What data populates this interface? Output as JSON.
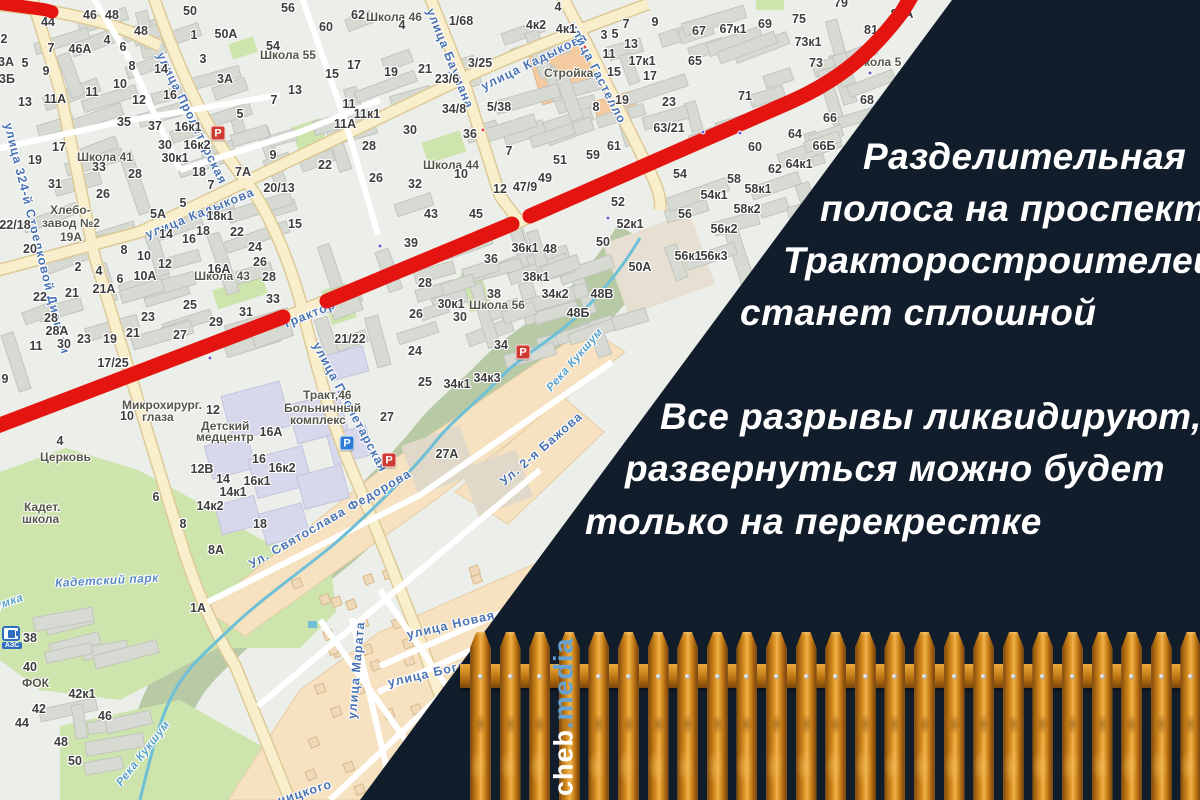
{
  "overlay": {
    "bg_color": "#121d2c",
    "text_color": "#ffffff",
    "headline_lines": [
      {
        "t": "Разделительная",
        "x": 863,
        "y": 136
      },
      {
        "t": "полоса на проспекте",
        "x": 820,
        "y": 188
      },
      {
        "t": "Тракторостроителей",
        "x": 783,
        "y": 240
      },
      {
        "t": "станет сплошной",
        "x": 740,
        "y": 292
      }
    ],
    "body_lines": [
      {
        "t": "Все разрывы ликвидируют,",
        "x": 660,
        "y": 396
      },
      {
        "t": "развернуться можно будет",
        "x": 625,
        "y": 448
      },
      {
        "t": "только на перекрестке",
        "x": 585,
        "y": 501
      }
    ]
  },
  "watermark": {
    "site": "cheb",
    "domain": ".media",
    "site_color": "#ffffff",
    "domain_color": "#66a3d2"
  },
  "map": {
    "route_color": "#e41410",
    "street_label_color": "#4a73b4",
    "street_labels": [
      {
        "t": "улица Пролетарская",
        "x": 160,
        "y": 46,
        "r": 64
      },
      {
        "t": "улица Пролетарская",
        "x": 316,
        "y": 336,
        "r": 62
      },
      {
        "t": "улица Баумана",
        "x": 430,
        "y": 2,
        "r": 68
      },
      {
        "t": "улица Кадыкова",
        "x": 146,
        "y": 228,
        "r": -22
      },
      {
        "t": "улица Кадыкова",
        "x": 482,
        "y": 80,
        "r": -26
      },
      {
        "t": "улица Гастелло",
        "x": 572,
        "y": 16,
        "r": 63
      },
      {
        "t": "улица 324-й Стрелковой Дивизии",
        "x": 8,
        "y": 116,
        "r": 76
      },
      {
        "t": "Ул. Святослава Федорова",
        "x": 250,
        "y": 558,
        "r": -30
      },
      {
        "t": "Ул. 2-я Бажова",
        "x": 502,
        "y": 476,
        "r": -41
      },
      {
        "t": "улица Новая",
        "x": 407,
        "y": 628,
        "r": -13
      },
      {
        "t": "улица Марата",
        "x": 352,
        "y": 712,
        "r": -85
      },
      {
        "t": "улица Богдана",
        "x": 388,
        "y": 676,
        "r": -13
      },
      {
        "t": "ницкого",
        "x": 278,
        "y": 794,
        "r": -18
      },
      {
        "t": "Трактор",
        "x": 283,
        "y": 318,
        "r": -22
      }
    ],
    "water_labels": [
      {
        "t": "Река Кукшум",
        "x": 549,
        "y": 384,
        "r": -49
      },
      {
        "t": "Река Кукшум",
        "x": 119,
        "y": 779,
        "r": -52
      },
      {
        "t": "Кукшумка",
        "x": -34,
        "y": 612,
        "r": -20
      }
    ],
    "park_labels": [
      {
        "t": "Кадетский парк",
        "x": 55,
        "y": 576,
        "r": -3
      }
    ],
    "poi_labels": [
      {
        "t": "Школа 41",
        "x": 77,
        "y": 150
      },
      {
        "t": "Школа 55",
        "x": 260,
        "y": 48
      },
      {
        "t": "Школа 46",
        "x": 366,
        "y": 10
      },
      {
        "t": "Школа 44",
        "x": 423,
        "y": 158
      },
      {
        "t": "Школа 43",
        "x": 194,
        "y": 269
      },
      {
        "t": "Школа 56",
        "x": 469,
        "y": 298
      },
      {
        "t": "Школа 5",
        "x": 852,
        "y": 55
      },
      {
        "t": "Хлебо-",
        "x": 50,
        "y": 203
      },
      {
        "t": "завод №2",
        "x": 42,
        "y": 216
      },
      {
        "t": "19А",
        "x": 60,
        "y": 230
      },
      {
        "t": "Микрохирург.",
        "x": 122,
        "y": 398
      },
      {
        "t": "глаза",
        "x": 142,
        "y": 410
      },
      {
        "t": "Детский",
        "x": 201,
        "y": 419
      },
      {
        "t": "медцентр",
        "x": 196,
        "y": 430
      },
      {
        "t": "Тракт,46",
        "x": 303,
        "y": 388
      },
      {
        "t": "Больничный",
        "x": 284,
        "y": 401
      },
      {
        "t": "комплекс",
        "x": 290,
        "y": 413
      },
      {
        "t": "Стройка",
        "x": 544,
        "y": 66
      },
      {
        "t": "Церковь",
        "x": 40,
        "y": 450
      },
      {
        "t": "Кадет.",
        "x": 24,
        "y": 500
      },
      {
        "t": "школа",
        "x": 22,
        "y": 512
      },
      {
        "t": "ФОК",
        "x": 22,
        "y": 676
      }
    ],
    "numbers": [
      [
        "44",
        48,
        22
      ],
      [
        "46",
        90,
        15
      ],
      [
        "48",
        112,
        15
      ],
      [
        "48",
        141,
        31
      ],
      [
        "4",
        107,
        40
      ],
      [
        "46А",
        80,
        49
      ],
      [
        "7",
        51,
        48
      ],
      [
        "5",
        25,
        63
      ],
      [
        "9",
        46,
        71
      ],
      [
        "3А",
        6,
        62
      ],
      [
        "3Б",
        7,
        79
      ],
      [
        "2",
        4,
        39
      ],
      [
        "6",
        123,
        47
      ],
      [
        "8",
        132,
        66
      ],
      [
        "14",
        161,
        69
      ],
      [
        "10",
        120,
        84
      ],
      [
        "11",
        92,
        92
      ],
      [
        "16",
        170,
        95
      ],
      [
        "12",
        139,
        100
      ],
      [
        "13",
        25,
        102
      ],
      [
        "11А",
        55,
        99
      ],
      [
        "35",
        124,
        122
      ],
      [
        "37",
        155,
        126
      ],
      [
        "16к1",
        188,
        127
      ],
      [
        "16к2",
        197,
        145
      ],
      [
        "17",
        59,
        147
      ],
      [
        "19",
        35,
        160
      ],
      [
        "33",
        99,
        167
      ],
      [
        "30",
        165,
        145
      ],
      [
        "30к1",
        175,
        158
      ],
      [
        "28",
        135,
        174
      ],
      [
        "18",
        199,
        172
      ],
      [
        "26",
        103,
        194
      ],
      [
        "31",
        55,
        184
      ],
      [
        "50",
        190,
        11
      ],
      [
        "1",
        194,
        35
      ],
      [
        "50А",
        226,
        34
      ],
      [
        "3",
        203,
        59
      ],
      [
        "3А",
        225,
        79
      ],
      [
        "54",
        273,
        46
      ],
      [
        "56",
        288,
        8
      ],
      [
        "13",
        295,
        90
      ],
      [
        "7",
        274,
        100
      ],
      [
        "5",
        240,
        114
      ],
      [
        "9",
        273,
        155
      ],
      [
        "7А",
        243,
        172
      ],
      [
        "20/13",
        279,
        188
      ],
      [
        "15",
        295,
        224
      ],
      [
        "22/18",
        15,
        225
      ],
      [
        "20",
        30,
        249
      ],
      [
        "5А",
        158,
        214
      ],
      [
        "5",
        183,
        203
      ],
      [
        "7",
        211,
        185
      ],
      [
        "14",
        166,
        234
      ],
      [
        "16",
        189,
        239
      ],
      [
        "18",
        203,
        231
      ],
      [
        "18к1",
        220,
        216
      ],
      [
        "22",
        237,
        232
      ],
      [
        "24",
        255,
        247
      ],
      [
        "26",
        260,
        262
      ],
      [
        "28",
        269,
        277
      ],
      [
        "16А",
        219,
        269
      ],
      [
        "2",
        78,
        267
      ],
      [
        "4",
        99,
        271
      ],
      [
        "6",
        120,
        279
      ],
      [
        "8",
        124,
        250
      ],
      [
        "10",
        144,
        256
      ],
      [
        "12",
        165,
        264
      ],
      [
        "10А",
        145,
        276
      ],
      [
        "21",
        72,
        293
      ],
      [
        "21А",
        104,
        289
      ],
      [
        "22",
        40,
        297
      ],
      [
        "28",
        51,
        318
      ],
      [
        "28А",
        57,
        331
      ],
      [
        "30",
        64,
        344
      ],
      [
        "11",
        36,
        346
      ],
      [
        "23",
        84,
        339
      ],
      [
        "19",
        110,
        339
      ],
      [
        "21",
        133,
        333
      ],
      [
        "23",
        148,
        317
      ],
      [
        "25",
        190,
        305
      ],
      [
        "27",
        180,
        335
      ],
      [
        "29",
        216,
        322
      ],
      [
        "31",
        246,
        312
      ],
      [
        "33",
        273,
        299
      ],
      [
        "17/25",
        113,
        363
      ],
      [
        "62",
        358,
        15
      ],
      [
        "60",
        326,
        27
      ],
      [
        "4",
        402,
        25
      ],
      [
        "1/68",
        461,
        21
      ],
      [
        "4к2",
        536,
        25
      ],
      [
        "4к1",
        566,
        29
      ],
      [
        "4",
        558,
        7
      ],
      [
        "3/25",
        480,
        63
      ],
      [
        "23/6",
        447,
        79
      ],
      [
        "17",
        354,
        65
      ],
      [
        "15",
        332,
        74
      ],
      [
        "19",
        391,
        72
      ],
      [
        "21",
        425,
        69
      ],
      [
        "11",
        349,
        104
      ],
      [
        "11к1",
        367,
        114
      ],
      [
        "11А",
        345,
        124
      ],
      [
        "34/8",
        454,
        109
      ],
      [
        "5/38",
        499,
        107
      ],
      [
        "30",
        410,
        130
      ],
      [
        "36",
        470,
        134
      ],
      [
        "28",
        369,
        146
      ],
      [
        "22",
        325,
        165
      ],
      [
        "26",
        376,
        178
      ],
      [
        "32",
        415,
        184
      ],
      [
        "10",
        461,
        174
      ],
      [
        "7",
        509,
        151
      ],
      [
        "12",
        500,
        189
      ],
      [
        "47/9",
        525,
        187
      ],
      [
        "49",
        545,
        178
      ],
      [
        "51",
        560,
        160
      ],
      [
        "59",
        593,
        155
      ],
      [
        "61",
        614,
        146
      ],
      [
        "8",
        596,
        107
      ],
      [
        "3",
        604,
        35
      ],
      [
        "5",
        615,
        34
      ],
      [
        "11",
        609,
        54
      ],
      [
        "15",
        614,
        72
      ],
      [
        "13",
        631,
        44
      ],
      [
        "17к1",
        642,
        61
      ],
      [
        "17",
        650,
        76
      ],
      [
        "9",
        655,
        22
      ],
      [
        "7",
        626,
        24
      ],
      [
        "19",
        622,
        100
      ],
      [
        "23",
        669,
        102
      ],
      [
        "65",
        695,
        61
      ],
      [
        "67",
        699,
        31
      ],
      [
        "67к1",
        733,
        29
      ],
      [
        "69",
        765,
        24
      ],
      [
        "75",
        799,
        19
      ],
      [
        "73к1",
        808,
        42
      ],
      [
        "73",
        816,
        63
      ],
      [
        "81",
        871,
        30
      ],
      [
        "81А",
        902,
        14
      ],
      [
        "79",
        841,
        3
      ],
      [
        "71",
        745,
        96
      ],
      [
        "63/21",
        669,
        128
      ],
      [
        "68",
        867,
        100
      ],
      [
        "66",
        830,
        118
      ],
      [
        "64",
        795,
        134
      ],
      [
        "66Б",
        824,
        146
      ],
      [
        "60",
        755,
        147
      ],
      [
        "62",
        775,
        169
      ],
      [
        "64к1",
        799,
        164
      ],
      [
        "58",
        734,
        179
      ],
      [
        "58к1",
        758,
        189
      ],
      [
        "54к1",
        714,
        195
      ],
      [
        "58к2",
        747,
        209
      ],
      [
        "56к2",
        724,
        229
      ],
      [
        "56к3",
        714,
        256
      ],
      [
        "43",
        431,
        214
      ],
      [
        "45",
        476,
        214
      ],
      [
        "39",
        411,
        243
      ],
      [
        "52",
        618,
        202
      ],
      [
        "54",
        680,
        174
      ],
      [
        "56",
        685,
        214
      ],
      [
        "52к1",
        630,
        224
      ],
      [
        "50",
        603,
        242
      ],
      [
        "56к1",
        688,
        256
      ],
      [
        "36к1",
        525,
        248
      ],
      [
        "48",
        550,
        249
      ],
      [
        "36",
        491,
        259
      ],
      [
        "28",
        425,
        283
      ],
      [
        "38к1",
        536,
        277
      ],
      [
        "38",
        494,
        294
      ],
      [
        "34к2",
        555,
        294
      ],
      [
        "48В",
        602,
        294
      ],
      [
        "48Б",
        578,
        313
      ],
      [
        "50А",
        640,
        267
      ],
      [
        "30к1",
        451,
        304
      ],
      [
        "30",
        460,
        317
      ],
      [
        "26",
        416,
        314
      ],
      [
        "24",
        415,
        351
      ],
      [
        "34",
        501,
        345
      ],
      [
        "25",
        425,
        382
      ],
      [
        "34к1",
        457,
        384
      ],
      [
        "34к3",
        487,
        378
      ],
      [
        "21/22",
        350,
        339
      ],
      [
        "27",
        387,
        417
      ],
      [
        "9",
        5,
        379
      ],
      [
        "4",
        60,
        441
      ],
      [
        "6",
        156,
        497
      ],
      [
        "8",
        183,
        524
      ],
      [
        "8А",
        216,
        550
      ],
      [
        "12В",
        202,
        469
      ],
      [
        "14",
        223,
        479
      ],
      [
        "14к1",
        233,
        492
      ],
      [
        "14к2",
        210,
        506
      ],
      [
        "16",
        259,
        459
      ],
      [
        "16к1",
        257,
        481
      ],
      [
        "16к2",
        282,
        468
      ],
      [
        "18",
        260,
        524
      ],
      [
        "16А",
        271,
        432
      ],
      [
        "1А",
        198,
        608
      ],
      [
        "38",
        30,
        638
      ],
      [
        "40",
        30,
        667
      ],
      [
        "42к1",
        82,
        694
      ],
      [
        "42",
        39,
        709
      ],
      [
        "44",
        22,
        723
      ],
      [
        "46",
        105,
        716
      ],
      [
        "48",
        61,
        742
      ],
      [
        "50",
        75,
        761
      ],
      [
        "27А",
        447,
        454
      ],
      [
        "10",
        127,
        416
      ],
      [
        "12",
        213,
        410
      ]
    ],
    "parking_icons": [
      {
        "x": 218,
        "y": 133,
        "c": "red"
      },
      {
        "x": 523,
        "y": 352,
        "c": "red"
      },
      {
        "x": 389,
        "y": 460,
        "c": "red"
      },
      {
        "x": 347,
        "y": 443,
        "c": "blue"
      }
    ],
    "stop_dots_purple": [
      [
        703,
        132
      ],
      [
        740,
        133
      ],
      [
        210,
        358
      ],
      [
        380,
        246
      ],
      [
        870,
        73
      ],
      [
        608,
        218
      ]
    ],
    "stop_dots_red": [
      [
        483,
        130
      ],
      [
        585,
        47
      ]
    ],
    "fuel_station_label": "АЗС"
  }
}
